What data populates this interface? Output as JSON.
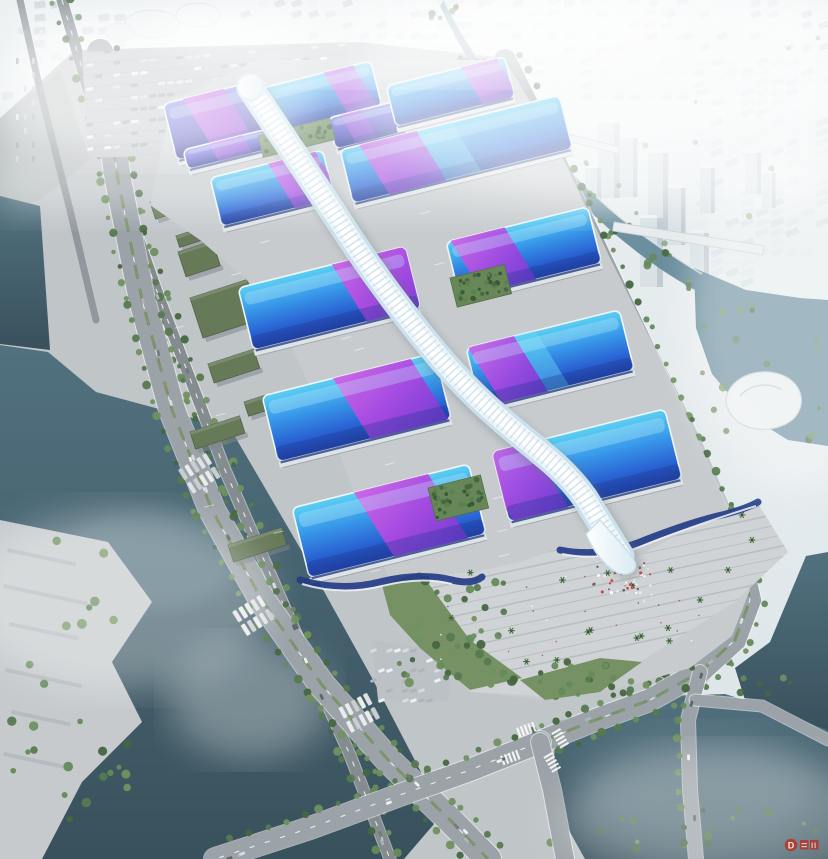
{
  "meta": {
    "title": "Aerial rendering of a riverside exhibition and convention center",
    "description": "Photorealistic bird's-eye architectural visualization: parallel rows of wave-form exhibition halls with cyan-to-blue gradient roofs swept by magenta-violet ribbons, linked by a white serpentine skylight concourse that cascades into a south entrance plaza with palm trees and crowds; complex is ringed by tree-lined boulevards, an elevated highway, truck and bus parking lots, green-roof service sheds, canals and rivers with bridges, and a dense low-rise city fading into white haze."
  },
  "scene": {
    "subject": "exhibition-convention-center",
    "hall_rows": 5,
    "north_hall_cluster_roofs": 4,
    "central_spine": "white serpentine concourse with diamond-grid skin",
    "south_feature": "spine cascades down wavy navy roof edge onto stepped entrance plaza",
    "water_bodies": [
      "upper-right city river with two bridges",
      "right-edge pond",
      "lower-left wide canal",
      "lower-right dark canal with road bridges",
      "far-left canal strip"
    ],
    "crowd": "red and white visitor specks on south plaza",
    "vehicles": "trucks in north lot, buses along west aprons, cars on boulevards"
  },
  "watermark": {
    "letter": "D"
  },
  "palette": {
    "sky_top": "#f3f6f8",
    "sky_mid": "#e3eaee",
    "sky_low": "#d9e2e6",
    "city_light": "#e2e9ec",
    "city_mid": "#d0dade",
    "city_dark": "#c0cbd1",
    "ground": "#bdc2c6",
    "apron": "#c4c9cc",
    "terrace": "#cdd1d3",
    "road": "#979fa4",
    "road_dark": "#7e868b",
    "road_edge": "#ffffff",
    "roof_cyan": "#4ecdf2",
    "roof_blue": "#2877e2",
    "roof_deep": "#1c41b4",
    "roof_navy": "#142e8c",
    "ribbon_pink": "#d45ee6",
    "ribbon_magenta": "#a63fe0",
    "ribbon_violet": "#6c2fd0",
    "spine_white": "#ffffff",
    "spine_ice": "#ddedf5",
    "spine_shade": "#a9c9da",
    "river_teal": "#7fa0af",
    "river_deep": "#56808f",
    "water_dark": "#3c5a68",
    "water_night": "#2e4854",
    "green_tree": "#4e7347",
    "green_tree2": "#5d8552",
    "green_dark": "#3c5f37",
    "green_lawn": "#6f8d5d",
    "green_roofshed": "#5f7350",
    "watermark_red": "#b63226"
  }
}
